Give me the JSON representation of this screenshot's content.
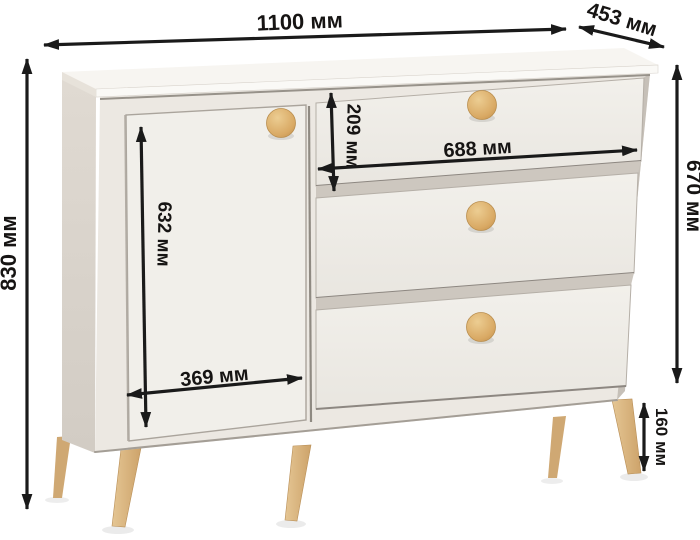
{
  "diagram": {
    "type": "furniture-dimension-diagram",
    "subject": "chest of drawers with one door and three drawers on wooden legs",
    "unit": "мм",
    "dimensions": {
      "total_width": "1100 мм",
      "depth": "453 мм",
      "total_height": "830 мм",
      "body_height": "670 мм",
      "top_drawer_height": "209 мм",
      "drawer_width": "688 мм",
      "door_height": "632 мм",
      "door_width": "369 мм",
      "leg_height": "160 мм"
    },
    "colors": {
      "background": "#ffffff",
      "top_surface": "#f7f5f1",
      "front_panel": "#ece8e2",
      "side_panel": "#d9d3cb",
      "door": "#f1efea",
      "drawer": "#efede8",
      "gap_shadow": "#c6c0b8",
      "knob_wood": "#d9a964",
      "leg_wood": "#dcb888",
      "dimension_ink": "#1a1a1a"
    },
    "counts": {
      "drawers": "3",
      "doors": "1",
      "knobs": "4"
    }
  }
}
